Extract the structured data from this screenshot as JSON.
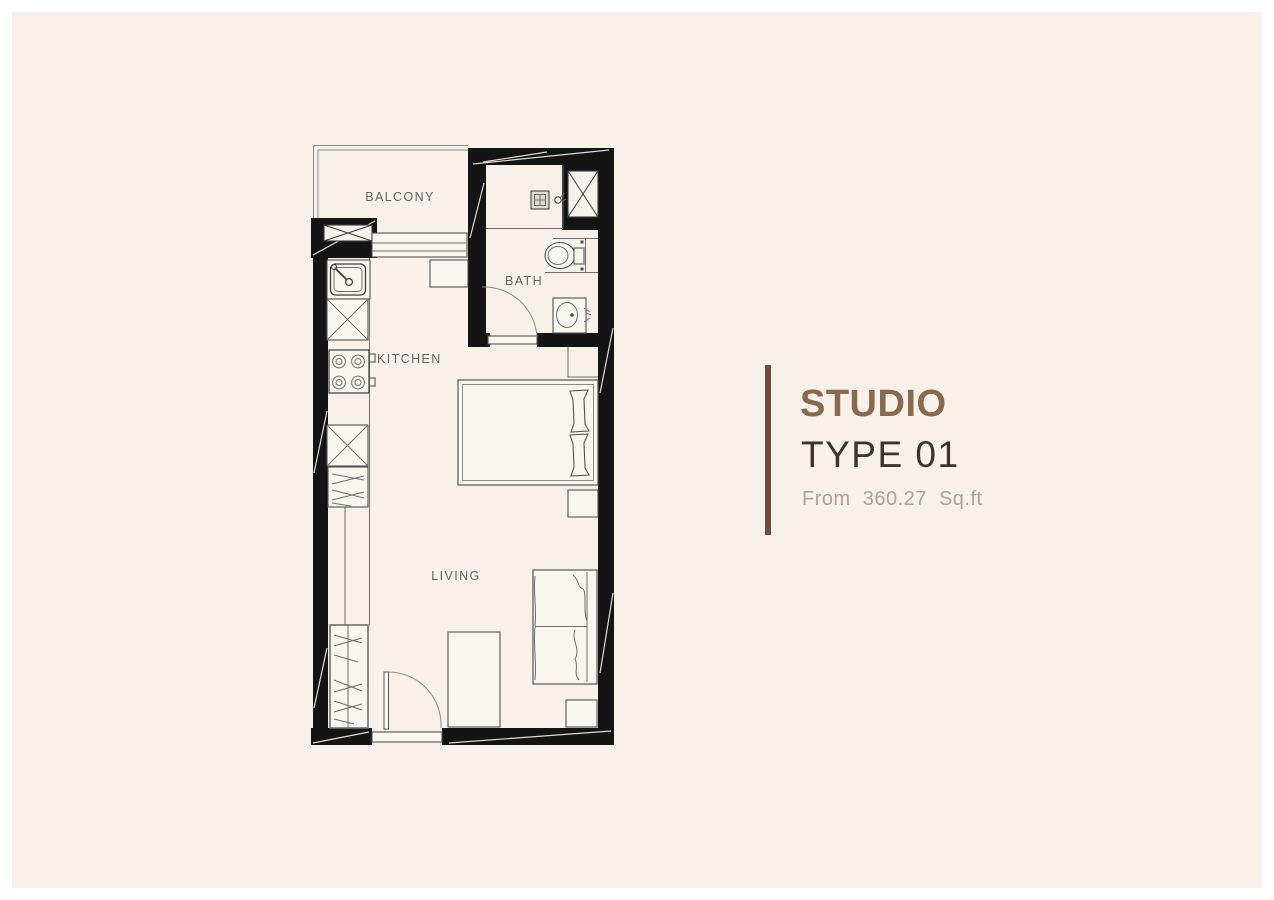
{
  "frame": {
    "border_color": "#ffffff",
    "panel_color": "#f7f1ea"
  },
  "floor_plan": {
    "wall_color": "#141414",
    "line_color": "#6f6f6f",
    "labels": {
      "balcony": "BALCONY",
      "kitchen": "KITCHEN",
      "bath": "BATH",
      "living": "LIVING"
    },
    "fixtures": [
      "balcony-parapet",
      "sliding-window",
      "ac-unit-box",
      "kitchen-sink",
      "base-cabinet-x",
      "stove-4-burner",
      "base-cabinet-x",
      "refrigerator-hatched",
      "counter-ledge",
      "wardrobe-hangers",
      "entry-door-swing",
      "entry-threshold",
      "shoe-cabinet",
      "sofa-2-seat",
      "side-table",
      "double-bed",
      "pillows",
      "nightstand",
      "storage-niche",
      "bath-door-swing",
      "vanity-basin",
      "toilet",
      "shower-drain",
      "shower-mixer",
      "duct-shaft-x"
    ]
  },
  "title_block": {
    "name": "STUDIO",
    "type": "TYPE 01",
    "area": "From 360.27 Sq.ft",
    "name_color": "#8a684c",
    "type_color": "#39342e",
    "area_color": "#a8a39e",
    "bar_color": "#6d4b3f"
  }
}
